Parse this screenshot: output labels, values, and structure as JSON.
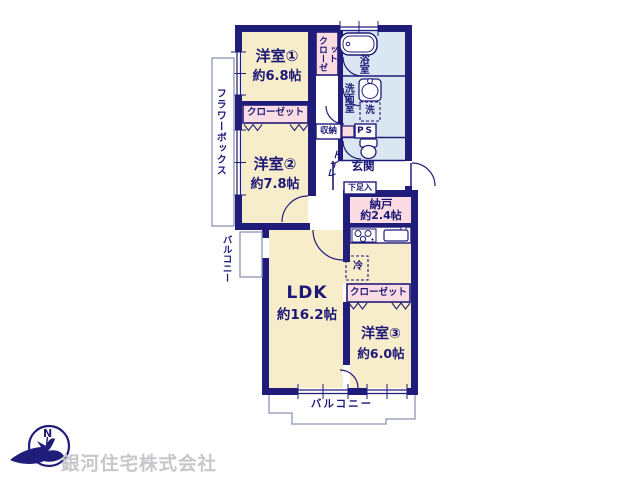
{
  "floorplan": {
    "rooms": {
      "room1": {
        "name": "洋室①",
        "size": "約6.8帖"
      },
      "room2": {
        "name": "洋室②",
        "size": "約7.8帖"
      },
      "room3": {
        "name": "洋室③",
        "size": "約6.0帖"
      },
      "ldk": {
        "name": "LDK",
        "size": "約16.2帖"
      },
      "nando": {
        "name": "納戸",
        "size": "約2.4帖"
      }
    },
    "labels": {
      "closet1": "クローゼット",
      "closet2": "クローゼット",
      "closet3": "クローゼット",
      "bathroom": "浴室",
      "washroom": "洗面室",
      "laundry": "洗",
      "ps": "PS",
      "storage": "収納",
      "toilet": "トイレ",
      "entrance": "玄関",
      "shoe_box": "下足入",
      "fridge": "冷",
      "flower_box": "フラワーボックス",
      "balcony_left": "バルコニー",
      "balcony_bottom": "バルコニー"
    }
  },
  "branding": {
    "company_name": "銀河住宅株式会社",
    "logo_letter": "N"
  },
  "colors": {
    "wall_navy": "#201c7a",
    "room_cream": "#f8edca",
    "closet_pink": "#fbdce2",
    "wet_area_blue": "#dbe6f3",
    "text_navy": "#1c1878",
    "balcony_line_gray": "#8d95b8",
    "company_text_gray": "#c7c7cb"
  }
}
